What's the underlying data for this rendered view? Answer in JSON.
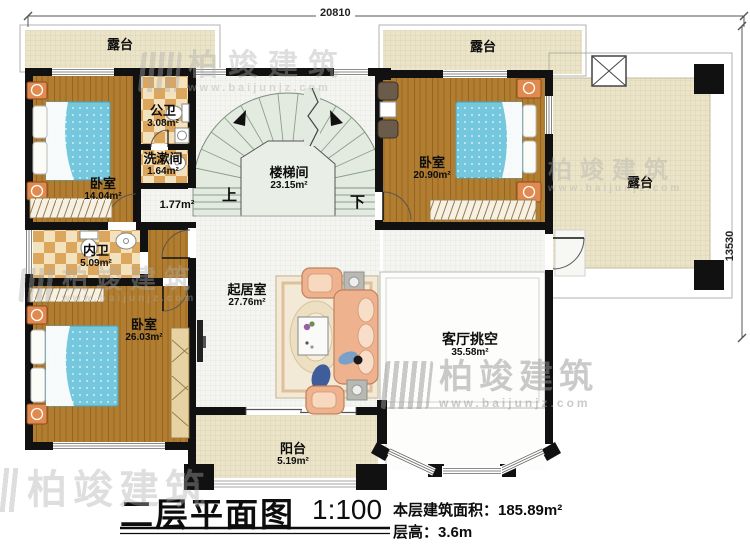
{
  "colors": {
    "wall": "#111111",
    "wood_floor": "#b17d30",
    "tile_dark": "#dca75c",
    "tile_light": "#f2e2bd",
    "terrace": "#ece4c8",
    "stair": "#e3ebe1",
    "bed_blue": "#74c7dc",
    "sofa_peach": "#efb28f",
    "nightstand_orange": "#e08a50"
  },
  "dimensions": {
    "top": "20810",
    "right": "13530"
  },
  "watermark": {
    "brand": "柏竣建筑",
    "url": "www.baijunjz.com"
  },
  "rooms": {
    "terrace_top_left": {
      "name": "露台"
    },
    "terrace_top_mid": {
      "name": "露台"
    },
    "terrace_right": {
      "name": "露台"
    },
    "bedroom_small": {
      "name": "卧室",
      "area": "14.04m²"
    },
    "public_bath": {
      "name": "公卫",
      "area": "3.08m²"
    },
    "washroom": {
      "name": "洗漱间",
      "area": "1.64m²"
    },
    "stairwell": {
      "name": "楼梯间",
      "area": "23.15m²"
    },
    "hallway": {
      "area": "1.77m²"
    },
    "bedroom_right": {
      "name": "卧室",
      "area": "20.90m²"
    },
    "inner_bath": {
      "name": "内卫",
      "area": "5.09m²"
    },
    "bedroom_large": {
      "name": "卧室",
      "area": "26.03m²"
    },
    "living_room": {
      "name": "起居室",
      "area": "27.76m²"
    },
    "void": {
      "name": "客厅挑空",
      "area": "35.58m²"
    },
    "balcony": {
      "name": "阳台",
      "area": "5.19m²"
    }
  },
  "stairs": {
    "up": "上",
    "down": "下"
  },
  "title": {
    "name": "二层平面图",
    "scale": "1:100",
    "area_line": "本层建筑面积：185.89m²",
    "height_line": "层高：3.6m"
  }
}
